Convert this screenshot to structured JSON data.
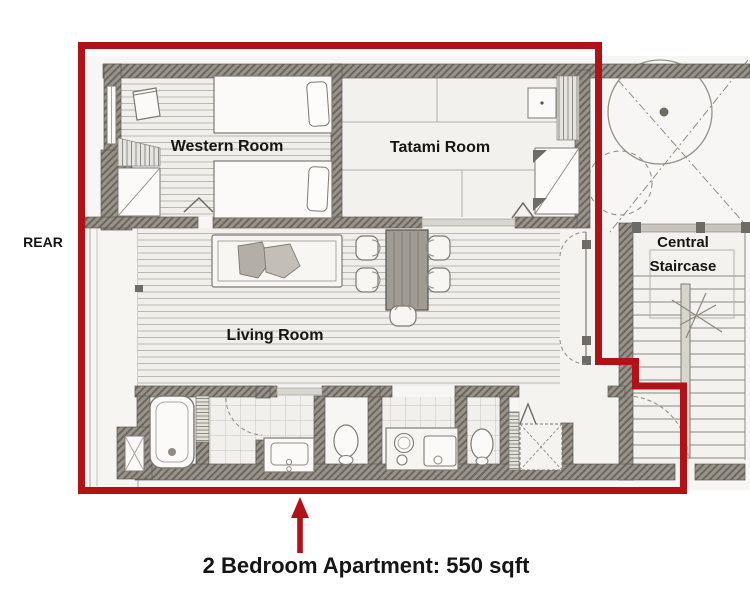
{
  "plan": {
    "side_label": "REAR",
    "rooms": {
      "western": "Western Room",
      "tatami": "Tatami Room",
      "living": "Living Room",
      "staircase_line1": "Central",
      "staircase_line2": "Staircase"
    },
    "caption": "2 Bedroom Apartment: 550 sqft",
    "annotation": {
      "highlight_color": "#b11218",
      "arrow_direction": "up",
      "outline_shape": "apartment-boundary"
    },
    "sketch_colors": {
      "wall": "#98948c",
      "pencil": "#7d7a73",
      "paper": "#f7f6f4",
      "text": "#151515"
    }
  }
}
